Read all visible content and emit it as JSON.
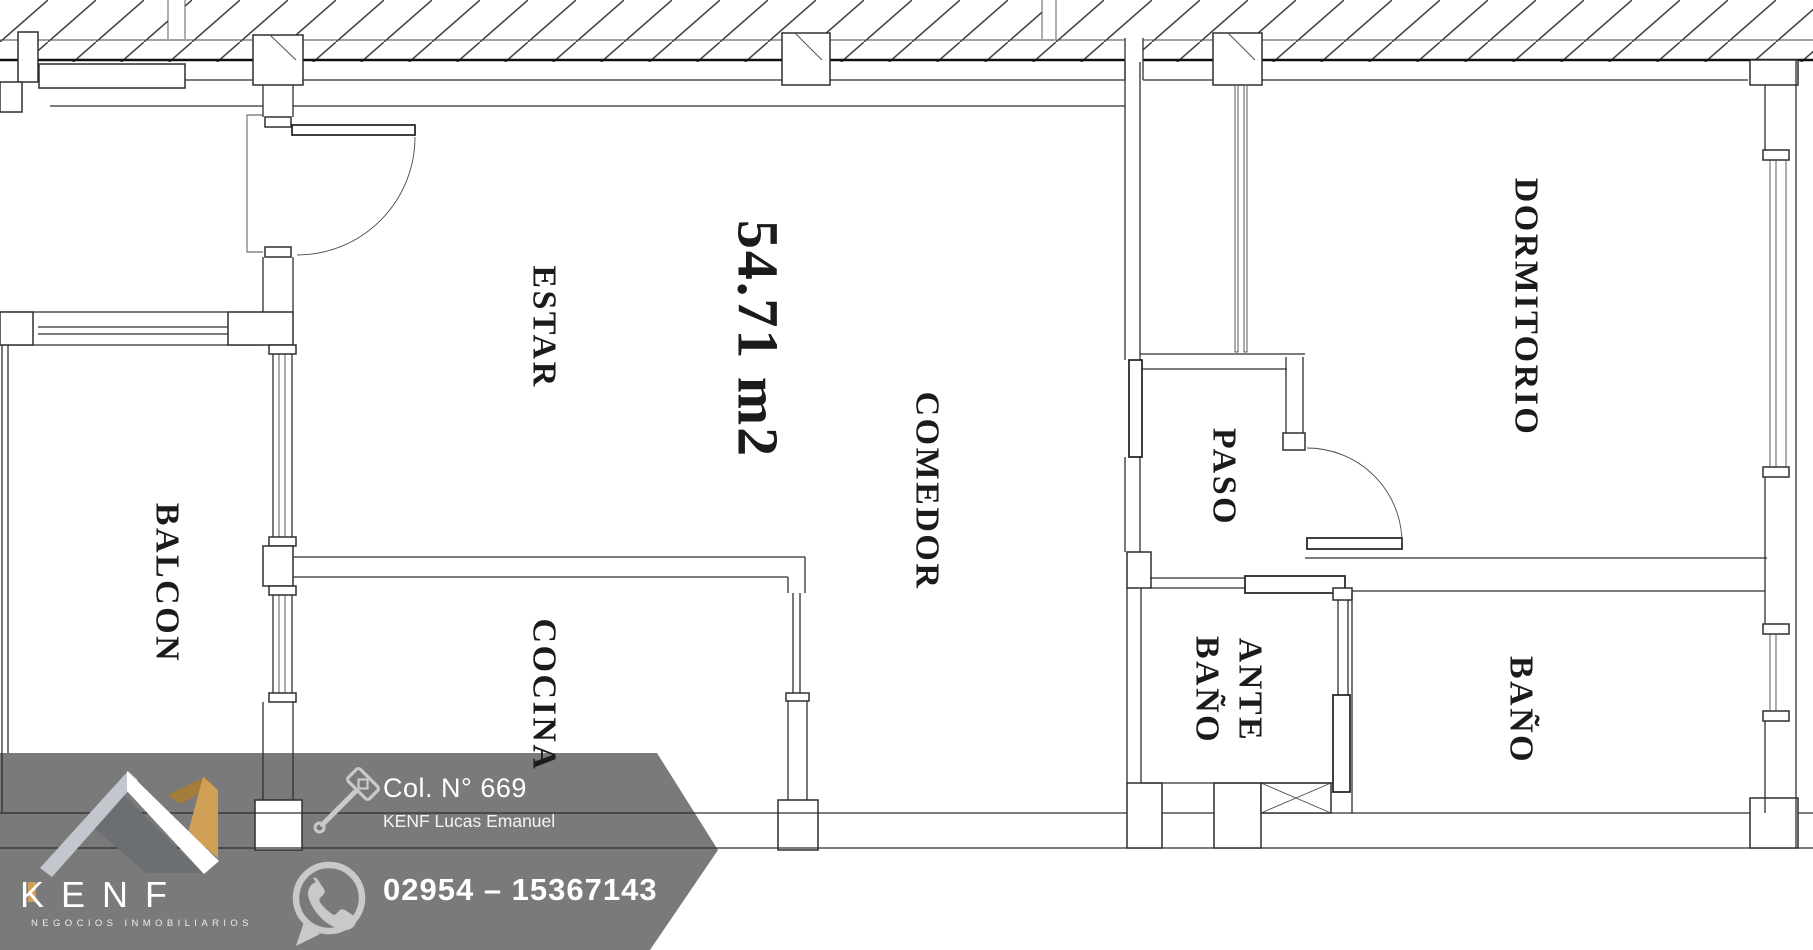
{
  "plan": {
    "area_label": "54.71 m2",
    "rooms": [
      {
        "name": "ESTAR"
      },
      {
        "name": "COMEDOR"
      },
      {
        "name": "COCINA"
      },
      {
        "name": "BALCON"
      },
      {
        "name": "PASO"
      },
      {
        "name": "DORMITORIO"
      },
      {
        "name": "ANTE\nBAÑO"
      },
      {
        "name": "BAÑO"
      }
    ]
  },
  "banner": {
    "brand": "KENF",
    "tagline": "NEGOCIOS INMOBILIARIOS",
    "credential": "Col. N° 669",
    "agent": "KENF Lucas Emanuel",
    "phone": "02954 – 15367143",
    "icons": [
      "roof-logo",
      "gavel-icon",
      "whatsapp-icon"
    ],
    "colors": {
      "banner_gray": "#7a7a7a",
      "gold": "#cfa055",
      "gold_dark": "#a57d3a",
      "logo_light_gray": "#c2c6cd",
      "logo_mid_gray": "#6b6f74",
      "icon_gray": "#c9c9c9",
      "line_dark": "#2f2f2f"
    }
  }
}
